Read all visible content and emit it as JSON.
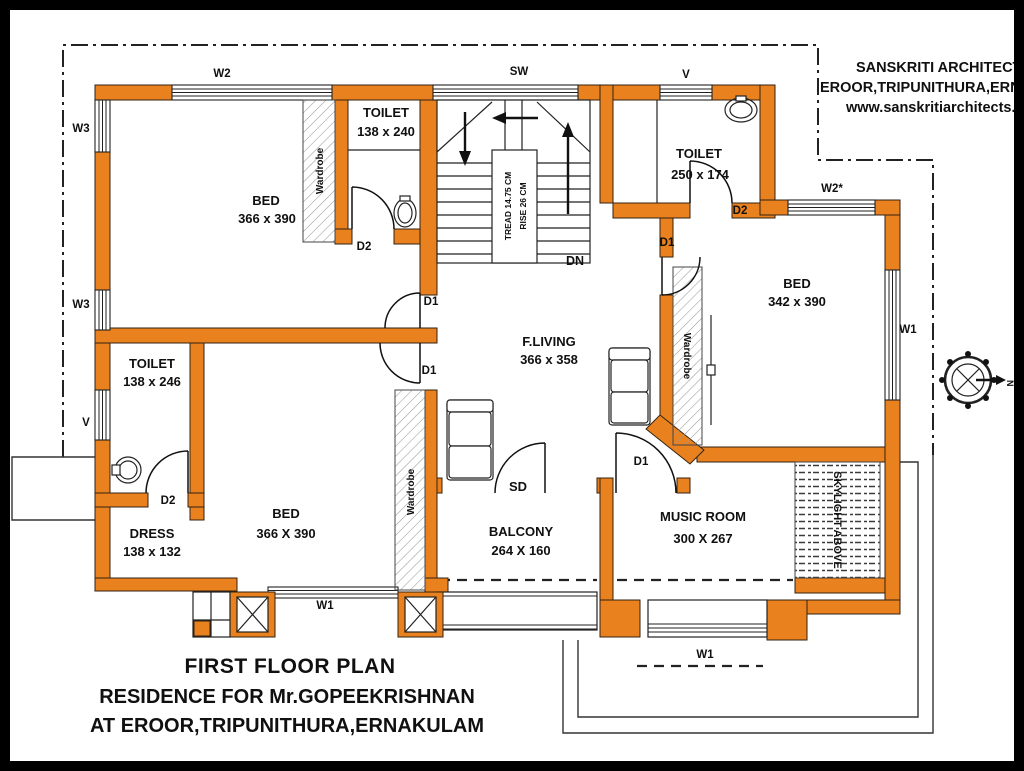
{
  "colors": {
    "wall_orange": "#E8811E",
    "line": "#222222"
  },
  "architect_block": {
    "name": "SANSKRITI ARCHITECTS",
    "address": "EROOR,TRIPUNITHURA,ERNAK",
    "website": "www.sanskritiarchitects.in"
  },
  "title_block": {
    "line1": "FIRST FLOOR PLAN",
    "line2": "RESIDENCE FOR Mr.GOPEEKRISHNAN",
    "line3": "AT EROOR,TRIPUNITHURA,ERNAKULAM"
  },
  "rooms": {
    "bed_top_left": {
      "name": "BED",
      "dims": "366 x 390"
    },
    "toilet_top_left": {
      "name": "TOILET",
      "dims": "138 x 240"
    },
    "toilet_top_right": {
      "name": "TOILET",
      "dims": "250 x 174"
    },
    "bed_right": {
      "name": "BED",
      "dims": "342 x 390"
    },
    "living": {
      "name": "F.LIVING",
      "dims": "366 x 358"
    },
    "toilet_left": {
      "name": "TOILET",
      "dims": "138 x 246"
    },
    "dress": {
      "name": "DRESS",
      "dims": "138 x 132"
    },
    "bed_bottom": {
      "name": "BED",
      "dims": "366 X 390"
    },
    "balcony": {
      "name": "BALCONY",
      "dims": "264 X 160"
    },
    "music_room": {
      "name": "MUSIC ROOM",
      "dims": "300 X 267"
    }
  },
  "stair": {
    "tread": "TREAD 14.75 CM",
    "rise": "RISE 26 CM",
    "down": "DN"
  },
  "labels": {
    "w1": "W1",
    "w2": "W2",
    "w2s": "W2*",
    "w3": "W3",
    "v": "V",
    "sw": "SW",
    "sd": "SD",
    "d1": "D1",
    "d2": "D2",
    "wardrobe": "Wardrobe",
    "skylight": "SKYLIGHT ABOVE",
    "north": "N"
  }
}
